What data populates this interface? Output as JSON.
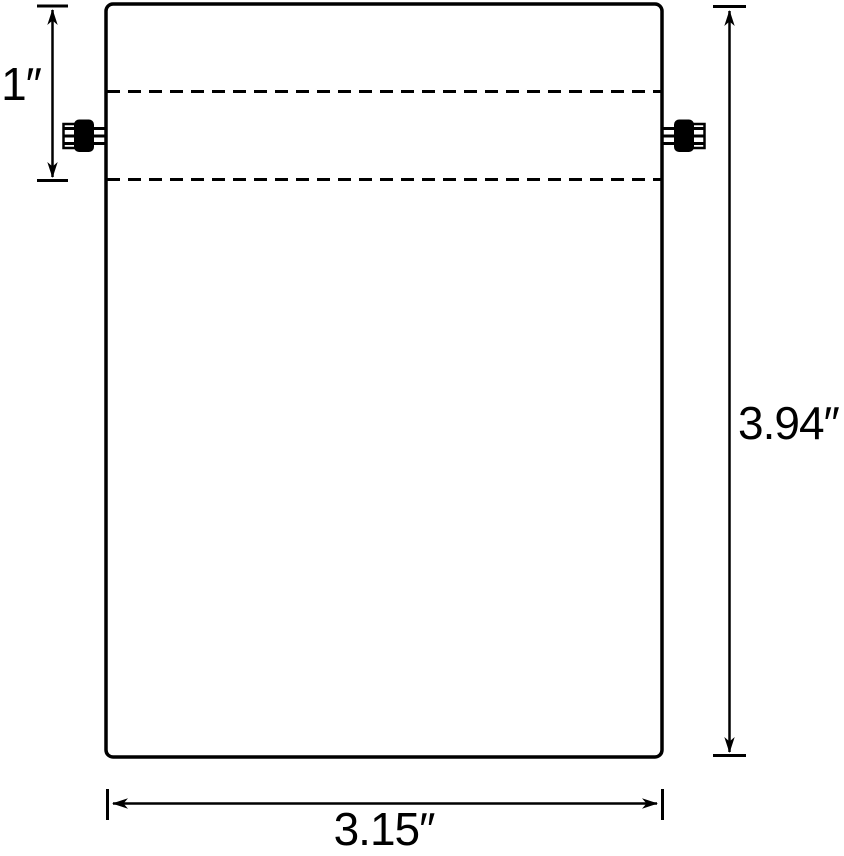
{
  "colors": {
    "ink": "#000000",
    "background": "#ffffff"
  },
  "diagram": {
    "type": "product-dimension-diagram",
    "subject": "drawstring-bag-front-view",
    "unit_symbol": "″",
    "labels": {
      "channel_height": "1″",
      "total_height": "3.94″",
      "total_width": "3.15″"
    },
    "values": {
      "channel_height_in": 1,
      "total_height_in": 3.94,
      "total_width_in": 3.15
    }
  }
}
